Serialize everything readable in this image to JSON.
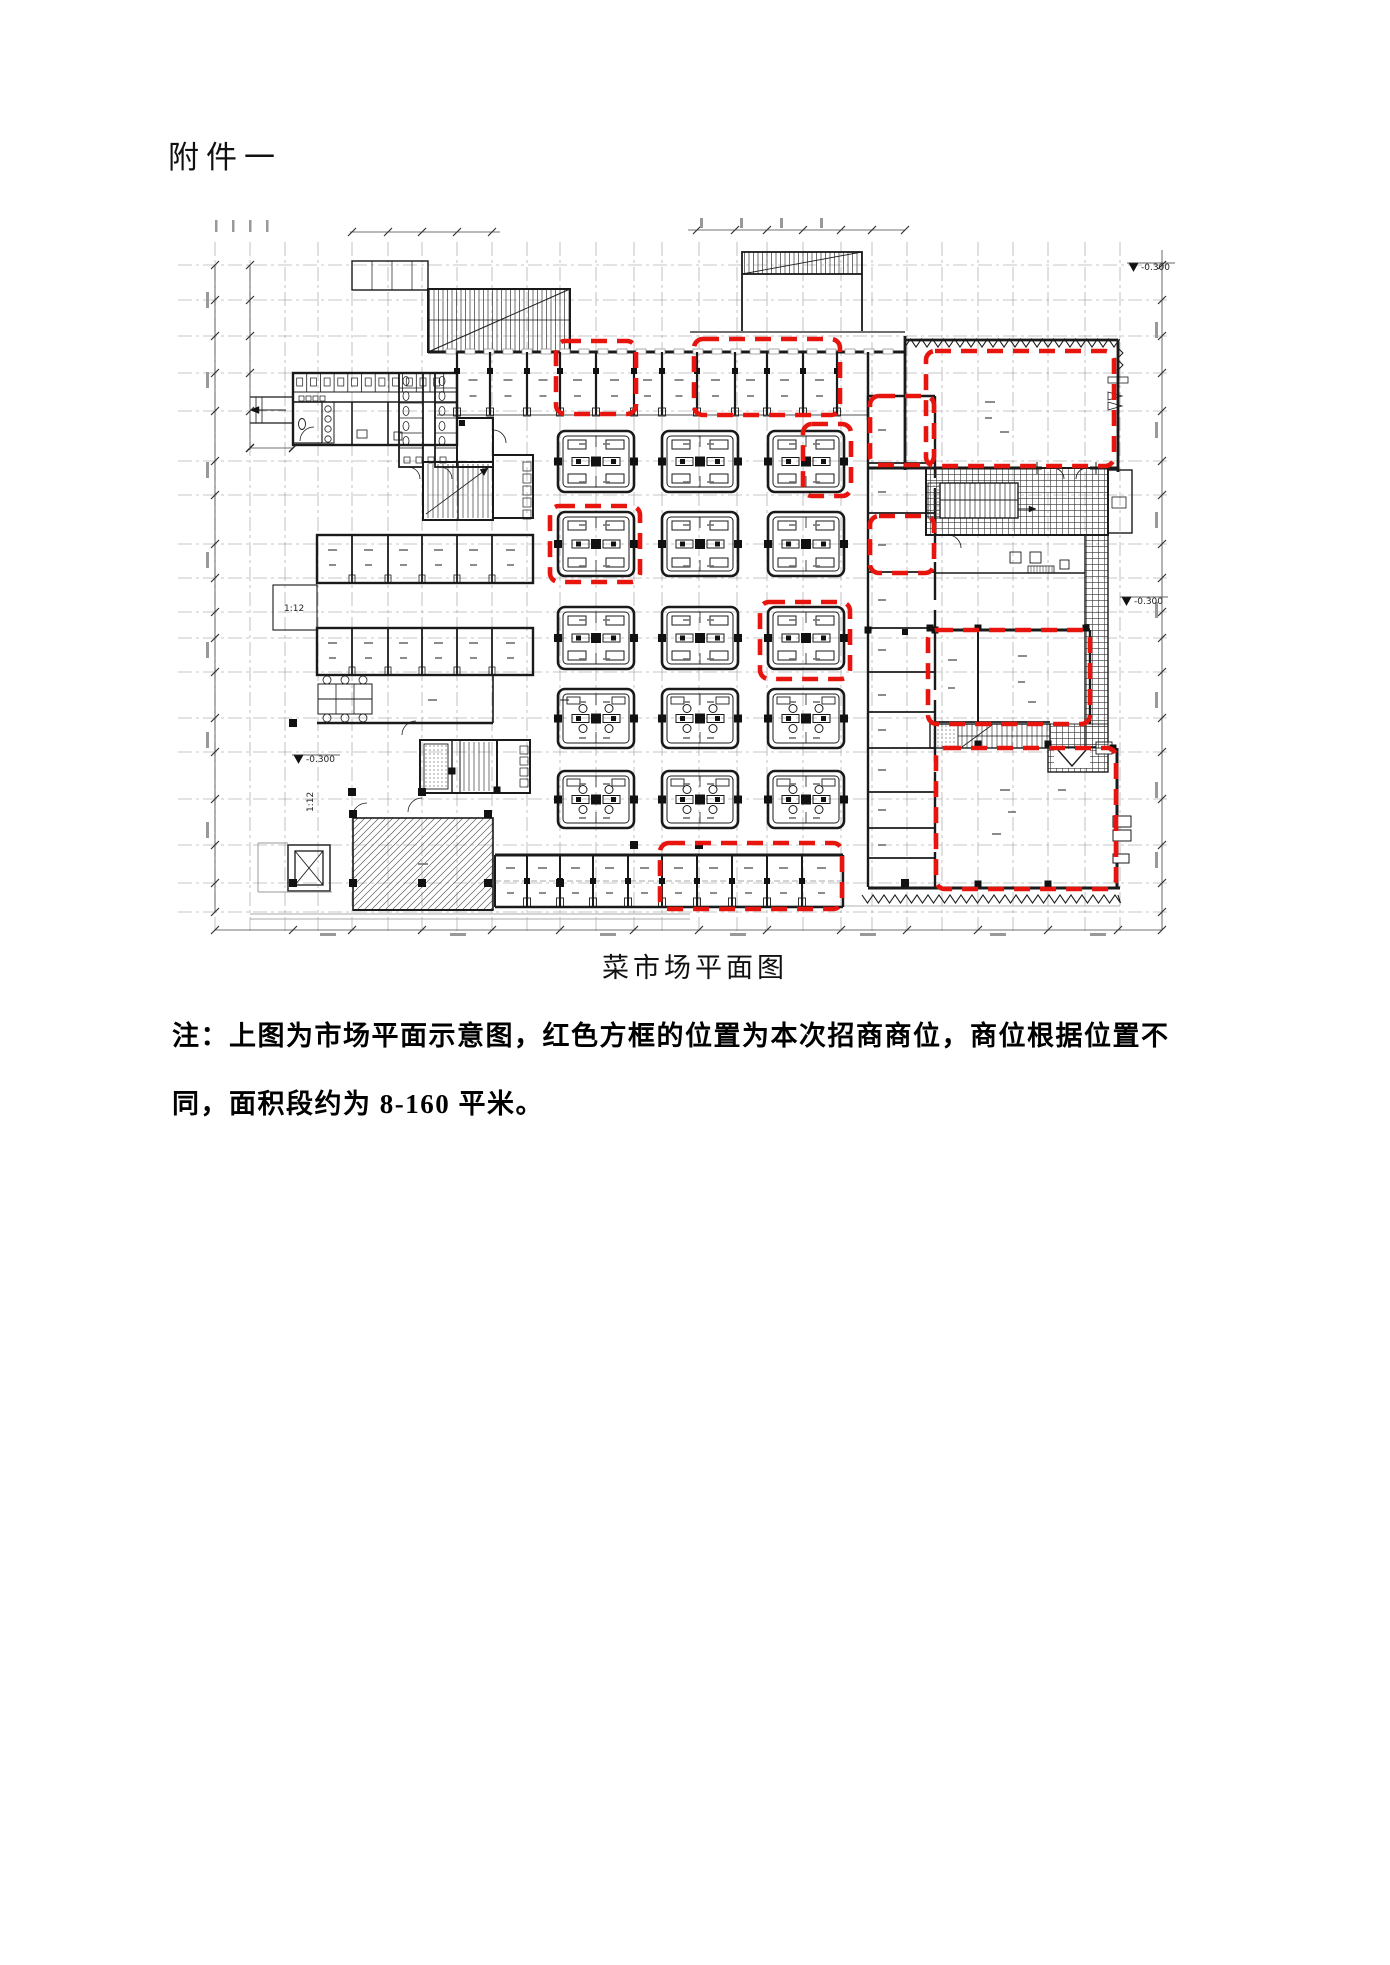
{
  "header": {
    "title": "附件一"
  },
  "figure": {
    "caption": "菜市场平面图",
    "ink_color": "#1a1a1a",
    "grid_color": "#8f8f8f",
    "red_color": "#e8150f",
    "commercial_spots": [
      {
        "id": "spot-top-row-left",
        "x": 556,
        "y": 341,
        "w": 80,
        "h": 73
      },
      {
        "id": "spot-top-row-right",
        "x": 694,
        "y": 339,
        "w": 146,
        "h": 76
      },
      {
        "id": "spot-hall-top-right",
        "x": 926,
        "y": 351,
        "w": 188,
        "h": 115
      },
      {
        "id": "spot-room-upper",
        "x": 870,
        "y": 396,
        "w": 64,
        "h": 69
      },
      {
        "id": "spot-room-lower",
        "x": 870,
        "y": 516,
        "w": 64,
        "h": 57
      },
      {
        "id": "spot-island-row1",
        "x": 803,
        "y": 424,
        "w": 48,
        "h": 72
      },
      {
        "id": "spot-island-row2",
        "x": 550,
        "y": 506,
        "w": 90,
        "h": 76
      },
      {
        "id": "spot-island-row3",
        "x": 760,
        "y": 602,
        "w": 90,
        "h": 77
      },
      {
        "id": "spot-hall-mid-right",
        "x": 928,
        "y": 630,
        "w": 162,
        "h": 94
      },
      {
        "id": "spot-hall-bottom-right",
        "x": 936,
        "y": 748,
        "w": 180,
        "h": 141
      },
      {
        "id": "spot-bottom-row",
        "x": 660,
        "y": 843,
        "w": 182,
        "h": 66
      }
    ],
    "islands": {
      "col_x": [
        558,
        662,
        768
      ],
      "col_w": 76,
      "row_y": [
        431,
        512,
        607,
        689,
        771
      ],
      "row_h": [
        61,
        64,
        62,
        59,
        57
      ],
      "circle_rows": [
        3,
        4
      ]
    },
    "annotations": [
      {
        "text": "-0.300",
        "x": 306,
        "y": 762,
        "level_mark": true
      },
      {
        "text": "-0.300",
        "x": 1134,
        "y": 604,
        "level_mark": true
      },
      {
        "text": "-0.300",
        "x": 1141,
        "y": 270,
        "level_mark": true
      },
      {
        "text": "1:12",
        "x": 284,
        "y": 611
      },
      {
        "text": "1:12",
        "x": 313,
        "y": 812,
        "rotate": -90
      }
    ]
  },
  "note": {
    "line1": "注：上图为市场平面示意图，红色方框的位置为本次招商商位，商位根据位置不",
    "line2": "同，面积段约为 8-160 平米。"
  }
}
